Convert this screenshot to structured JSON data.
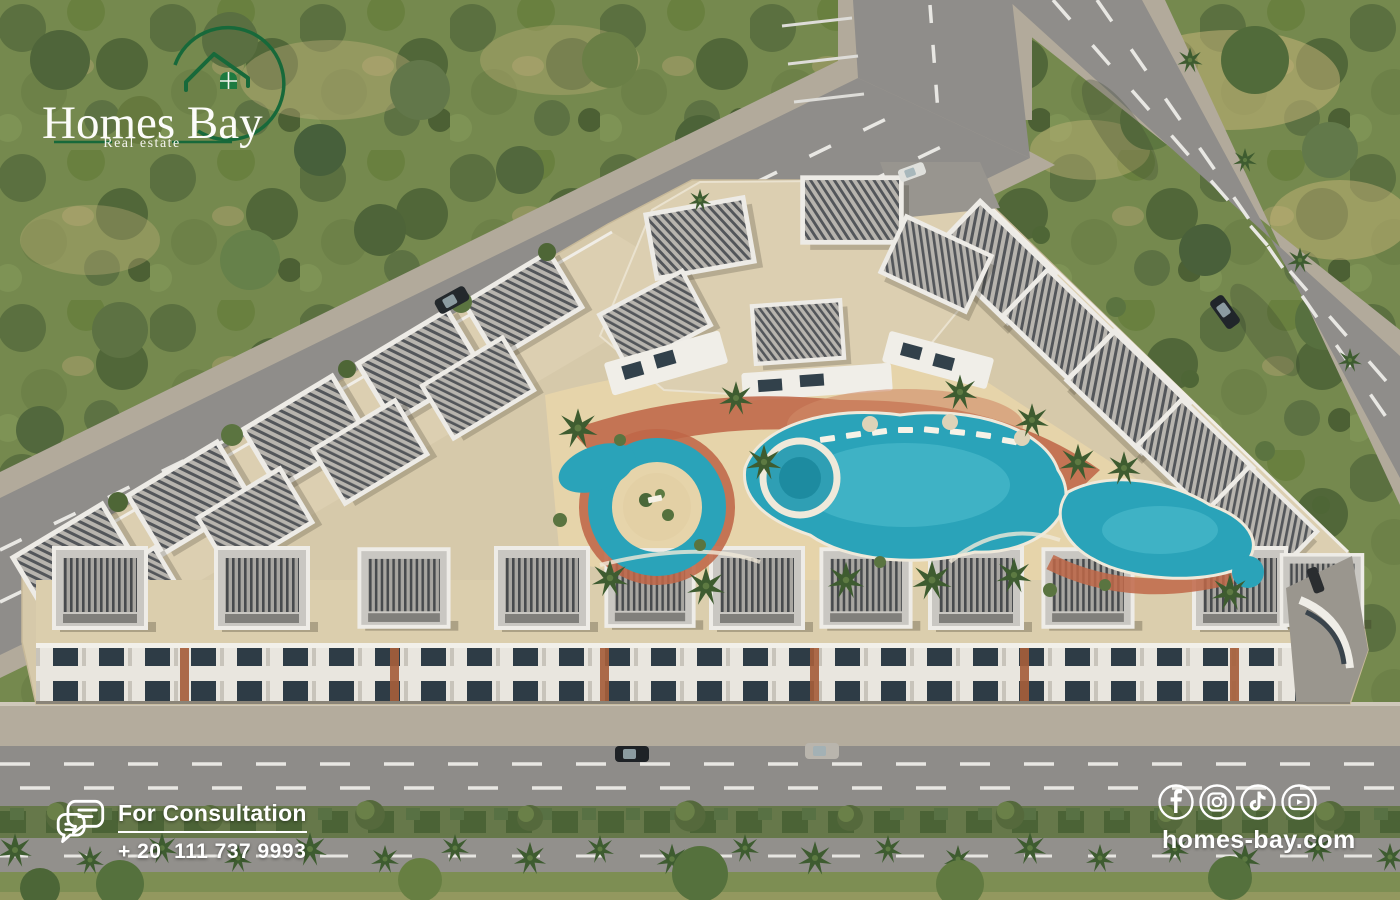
{
  "brand": {
    "name": "Homes Bay",
    "tagline": "Real estate",
    "logo_icon": "house-with-arc-icon",
    "green": "#17693a",
    "text_color": "#ffffff"
  },
  "consultation": {
    "label": "For Consultation",
    "phone": "+ 20  111 737 9993",
    "icon": "chat-bubbles-icon"
  },
  "social": {
    "website": "homes-bay.com",
    "icons": [
      "facebook-icon",
      "instagram-icon",
      "tiktok-icon",
      "youtube-icon"
    ]
  },
  "scene": {
    "type": "aerial-3d-render",
    "subject": "residential compound with central swimming pools and lazy river, ringed by roads, palm-lined boulevard and forest",
    "palette": {
      "forest_green": "#75894e",
      "road_gray": "#8f8d8a",
      "sidewalk": "#b4ac9d",
      "compound_beige": "#d6c9aa",
      "courtyard_sand": "#e6d4aa",
      "pool_teal": "#2aa3b9",
      "terracotta": "#bf6748",
      "median_green": "#66784a"
    }
  }
}
